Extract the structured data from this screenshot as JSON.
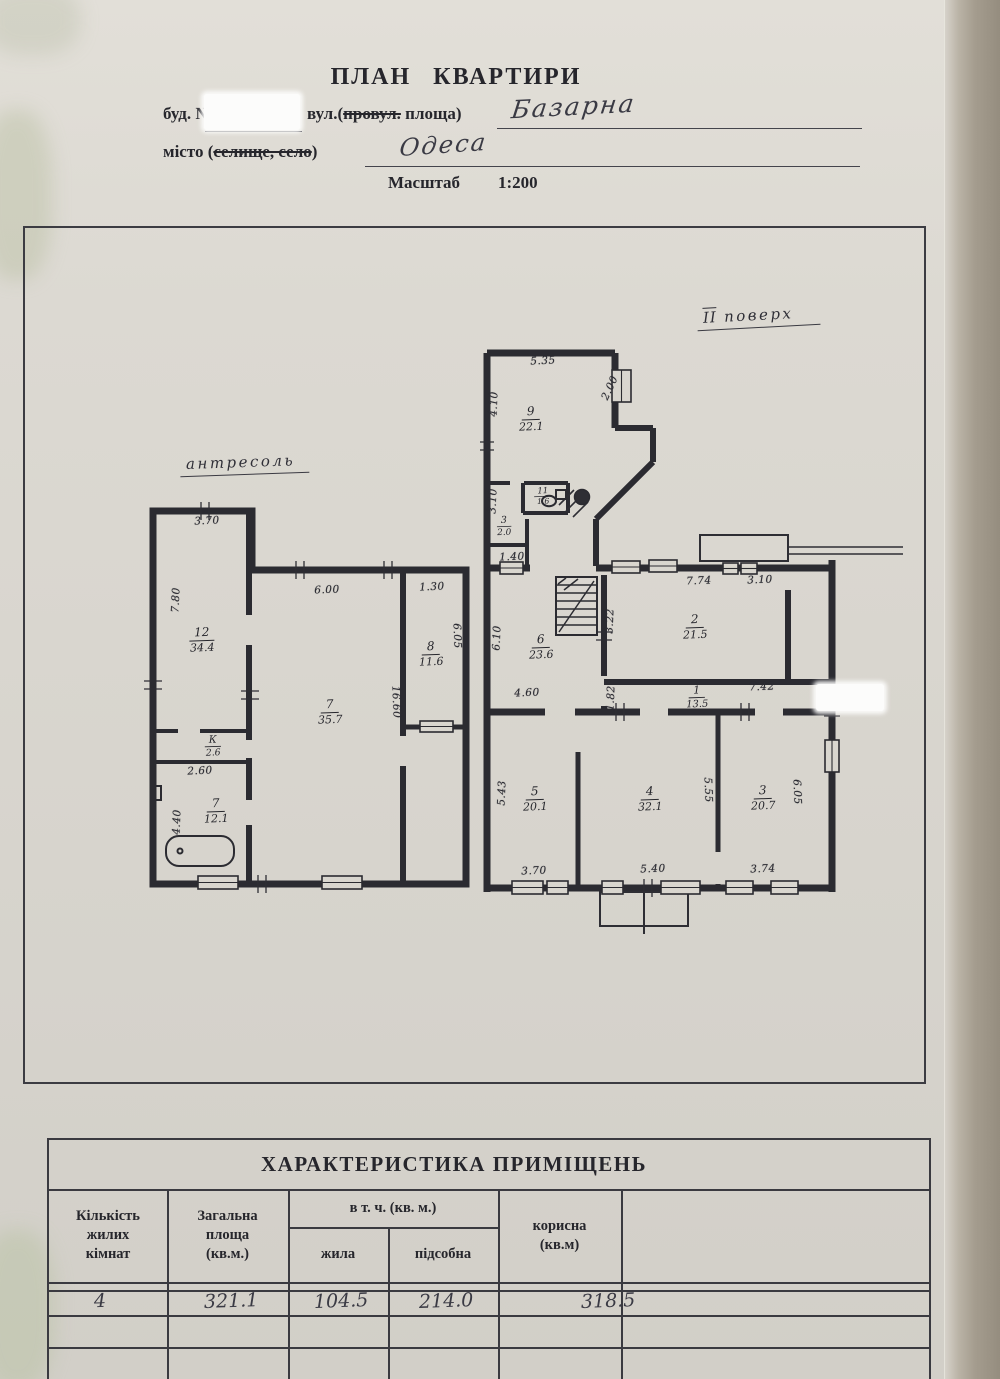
{
  "header": {
    "title": "ПЛАН  КВАРТИРИ",
    "building_label": "буд.  №",
    "street_label_pre": "вул.(",
    "street_label_struck": "провул.",
    "street_label_post": " площа)",
    "street_value": "Базарна",
    "city_label_pre": "місто (",
    "city_label_struck": "селище, село",
    "city_label_post": ")",
    "city_value": "Одеса",
    "scale_label": "Масштаб",
    "scale_value": "1:200"
  },
  "plan": {
    "left_section_label": "антресоль",
    "right_section_roman": "ІІ",
    "right_section_word": "поверх",
    "rooms": [
      {
        "n": "12",
        "a": "34.4",
        "x": 202,
        "y": 640
      },
      {
        "n": "7",
        "a": "35.7",
        "x": 330,
        "y": 712
      },
      {
        "n": "8",
        "a": "11.6",
        "x": 431,
        "y": 654
      },
      {
        "n": "К",
        "a": "2.6",
        "x": 213,
        "y": 746,
        "s": 0.85
      },
      {
        "n": "7",
        "a": "12.1",
        "x": 216,
        "y": 811
      },
      {
        "n": "9",
        "a": "22.1",
        "x": 531,
        "y": 419
      },
      {
        "n": "3",
        "a": "2.0",
        "x": 504,
        "y": 526,
        "s": 0.8
      },
      {
        "n": "11",
        "a": "1.6",
        "x": 543,
        "y": 496,
        "s": 0.7
      },
      {
        "n": "6",
        "a": "23.6",
        "x": 541,
        "y": 647
      },
      {
        "n": "2",
        "a": "21.5",
        "x": 695,
        "y": 627
      },
      {
        "n": "1",
        "a": "13.5",
        "x": 697,
        "y": 697,
        "s": 0.9
      },
      {
        "n": "5",
        "a": "20.1",
        "x": 535,
        "y": 799
      },
      {
        "n": "4",
        "a": "32.1",
        "x": 650,
        "y": 799
      },
      {
        "n": "3",
        "a": "20.7",
        "x": 763,
        "y": 798
      }
    ],
    "dims": [
      {
        "t": "3.70",
        "x": 207,
        "y": 521,
        "r": -3
      },
      {
        "t": "7.80",
        "x": 176,
        "y": 600,
        "r": -87
      },
      {
        "t": "6.00",
        "x": 327,
        "y": 590,
        "r": -2
      },
      {
        "t": "1.30",
        "x": 432,
        "y": 587,
        "r": -3
      },
      {
        "t": "6.05",
        "x": 457,
        "y": 636,
        "r": 88
      },
      {
        "t": "16.60",
        "x": 396,
        "y": 702,
        "r": 88
      },
      {
        "t": "2.60",
        "x": 200,
        "y": 771,
        "r": -3
      },
      {
        "t": "4.40",
        "x": 177,
        "y": 822,
        "r": -88
      },
      {
        "t": "5.35",
        "x": 543,
        "y": 361,
        "r": -3
      },
      {
        "t": "4.10",
        "x": 494,
        "y": 404,
        "r": -88
      },
      {
        "t": "2.00",
        "x": 610,
        "y": 388,
        "r": -65
      },
      {
        "t": "3.10",
        "x": 493,
        "y": 501,
        "r": -87
      },
      {
        "t": "1.40",
        "x": 512,
        "y": 557,
        "r": -2
      },
      {
        "t": "6.10",
        "x": 497,
        "y": 638,
        "r": -88
      },
      {
        "t": "4.60",
        "x": 527,
        "y": 693,
        "r": -2
      },
      {
        "t": "7.74",
        "x": 699,
        "y": 581,
        "r": -2
      },
      {
        "t": "3.10",
        "x": 760,
        "y": 580,
        "r": -2
      },
      {
        "t": "3.22",
        "x": 610,
        "y": 621,
        "r": -88
      },
      {
        "t": "1.82",
        "x": 611,
        "y": 698,
        "r": -88
      },
      {
        "t": "7.42",
        "x": 762,
        "y": 687,
        "r": -2
      },
      {
        "t": "5.43",
        "x": 502,
        "y": 793,
        "r": -88
      },
      {
        "t": "3.70",
        "x": 534,
        "y": 871,
        "r": -2
      },
      {
        "t": "5.40",
        "x": 653,
        "y": 869,
        "r": -2
      },
      {
        "t": "5.55",
        "x": 708,
        "y": 790,
        "r": 88
      },
      {
        "t": "3.74",
        "x": 763,
        "y": 869,
        "r": -2
      },
      {
        "t": "6.05",
        "x": 797,
        "y": 792,
        "r": 88
      }
    ]
  },
  "table": {
    "title": "ХАРАКТЕРИСТИКА ПРИМІЩЕНЬ",
    "col_rooms": "Кількість\nжилих\nкімнат",
    "col_total": "Загальна\nплоща\n(кв.м.)",
    "col_incl": "в т. ч. (кв. м.)",
    "col_living": "жила",
    "col_utility": "підсобна",
    "col_useful": "корисна\n(кв.м)",
    "values": {
      "rooms": "4",
      "total": "321.1",
      "living": "104.5",
      "utility": "214.0",
      "useful": "318.5"
    }
  },
  "colors": {
    "paper": "#dcd9d2",
    "ink": "#26262c",
    "plan_line": "#2b2b31"
  }
}
